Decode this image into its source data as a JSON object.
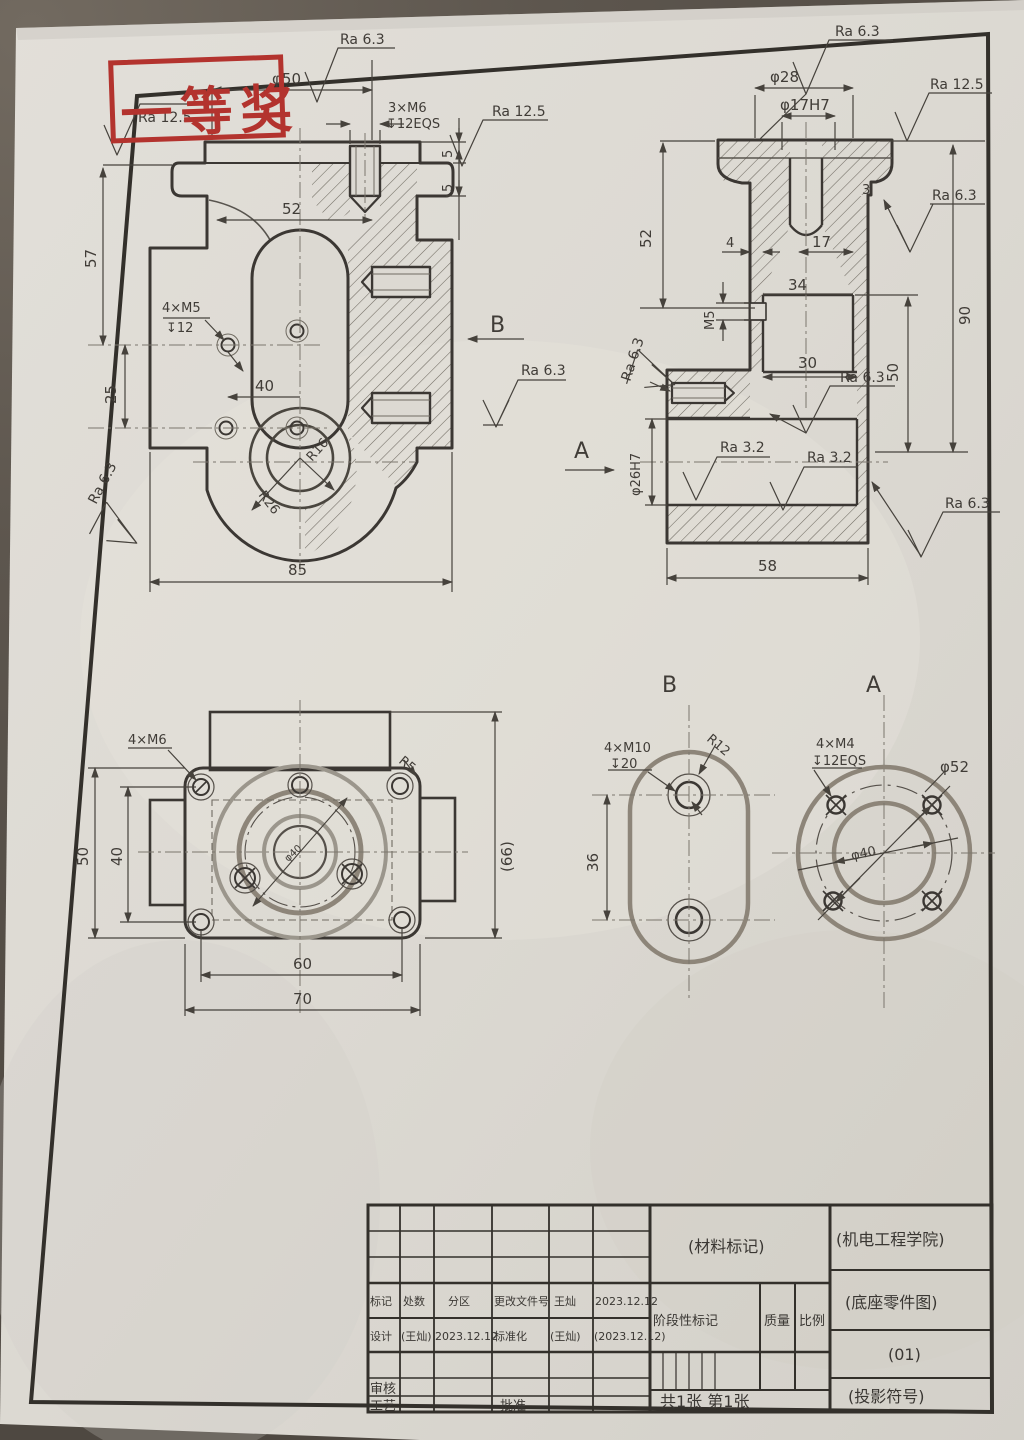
{
  "stamp": {
    "text": "一等奖",
    "color": "#b3332e"
  },
  "front_view": {
    "ra125_topleft": "Ra 12.5",
    "phi50": "φ50",
    "ra63_top": "Ra 6.3",
    "m6_count": "3×M6",
    "m6_depth": "↧12EQS",
    "ra125_right": "Ra 12.5",
    "t5a": "5",
    "t5b": "5",
    "d52": "52",
    "d57": "57",
    "m5_count": "4×M5",
    "m5_depth": "↧12",
    "d25": "25",
    "d40": "40",
    "r26": "R26",
    "r16": "R16",
    "d85": "85",
    "ra63_bl": "Ra 6.3",
    "b_arrow": "B",
    "ra63_b": "Ra 6.3"
  },
  "side_view": {
    "ra63_top": "Ra 6.3",
    "phi28": "φ28",
    "phi17": "φ17H7",
    "ra125_right": "Ra 12.5",
    "d3": "3",
    "ra63_right": "Ra 6.3",
    "d52": "52",
    "d4": "4",
    "d17": "17",
    "m5": "M5",
    "d34": "34",
    "d90": "90",
    "d50": "50",
    "d30": "30",
    "ra63_mid": "Ra 6.3",
    "a_arrow": "A",
    "ra63_left": "Ra 6.3",
    "phi26": "φ26H7",
    "ra32_a": "Ra 3.2",
    "ra32_b": "Ra 3.2",
    "ra63_br": "Ra 6.3",
    "d58": "58"
  },
  "bottom_view": {
    "m6_count": "4×M6",
    "r5": "R5",
    "d50": "50",
    "d40": "40",
    "d66": "(66)",
    "phi40": "φ40",
    "d60": "60",
    "d70": "70"
  },
  "b_view": {
    "title": "B",
    "m10_count": "4×M10",
    "m10_depth": "↧20",
    "r12": "R12",
    "d36": "36"
  },
  "a_view": {
    "title": "A",
    "m4_count": "4×M4",
    "m4_depth": "↧12EQS",
    "phi52": "φ52",
    "phi40": "φ40"
  },
  "title_block": {
    "material_note": "(材料标记)",
    "org": "(机电工程学院)",
    "row_mark": [
      "标记",
      "处数",
      "分区",
      "更改文件号",
      "王灿",
      "2023.12.12"
    ],
    "row_design": [
      "设计",
      "(王灿)",
      "2023.12.12",
      "标准化",
      "(王灿)",
      "(2023.12.12)"
    ],
    "stage_label": "阶段性标记",
    "mass_label": "质量",
    "scale_label": "比例",
    "drawing_title": "(底座零件图)",
    "drawing_no": "(01)",
    "sheet_info": "共1张 第1张",
    "projection_note": "(投影符号)",
    "audit_label": "审核",
    "process_label": "工艺",
    "approve_label": "批准"
  }
}
